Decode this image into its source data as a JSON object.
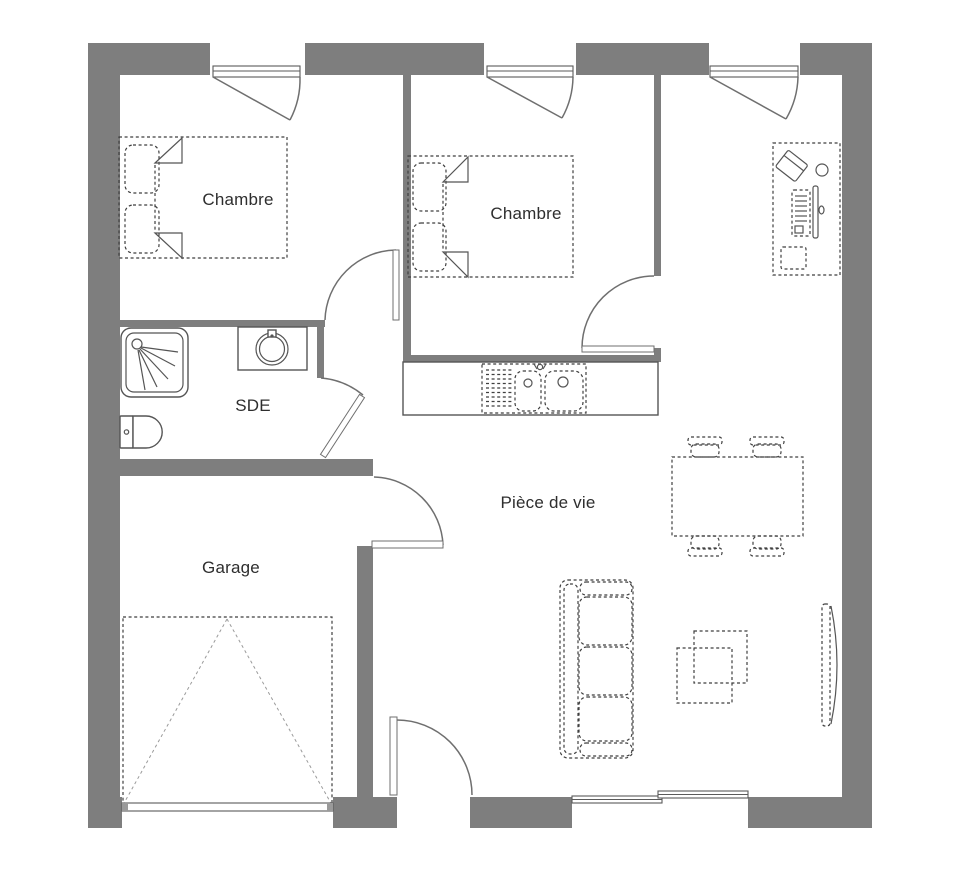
{
  "plan": {
    "type": "floor-plan",
    "rooms": [
      {
        "id": "chambre-1",
        "label": "Chambre"
      },
      {
        "id": "chambre-2",
        "label": "Chambre"
      },
      {
        "id": "sde",
        "label": "SDE"
      },
      {
        "id": "garage",
        "label": "Garage"
      },
      {
        "id": "piece-de-vie",
        "label": "Pièce de vie"
      }
    ],
    "fixtures": [
      "double-bed-with-nightstands",
      "double-bed-with-nightstands",
      "desk-with-laptop-keyboard-monitor",
      "kitchen-counter-double-sink",
      "shower-tray",
      "washbasin",
      "toilet",
      "dining-table-four-chairs",
      "three-seat-sofa",
      "nested-coffee-tables",
      "tv-screen",
      "up-and-over-garage-door",
      "entry-door",
      "sliding-bay-window",
      "casement-window",
      "casement-window",
      "casement-window"
    ],
    "colors": {
      "wall": "#7e7e7e",
      "furniture_line": "#3f3f3f",
      "door_line": "#6f6f6f",
      "fixture_line": "#555555",
      "label_text": "#2e2e2e",
      "background": "#ffffff"
    }
  }
}
